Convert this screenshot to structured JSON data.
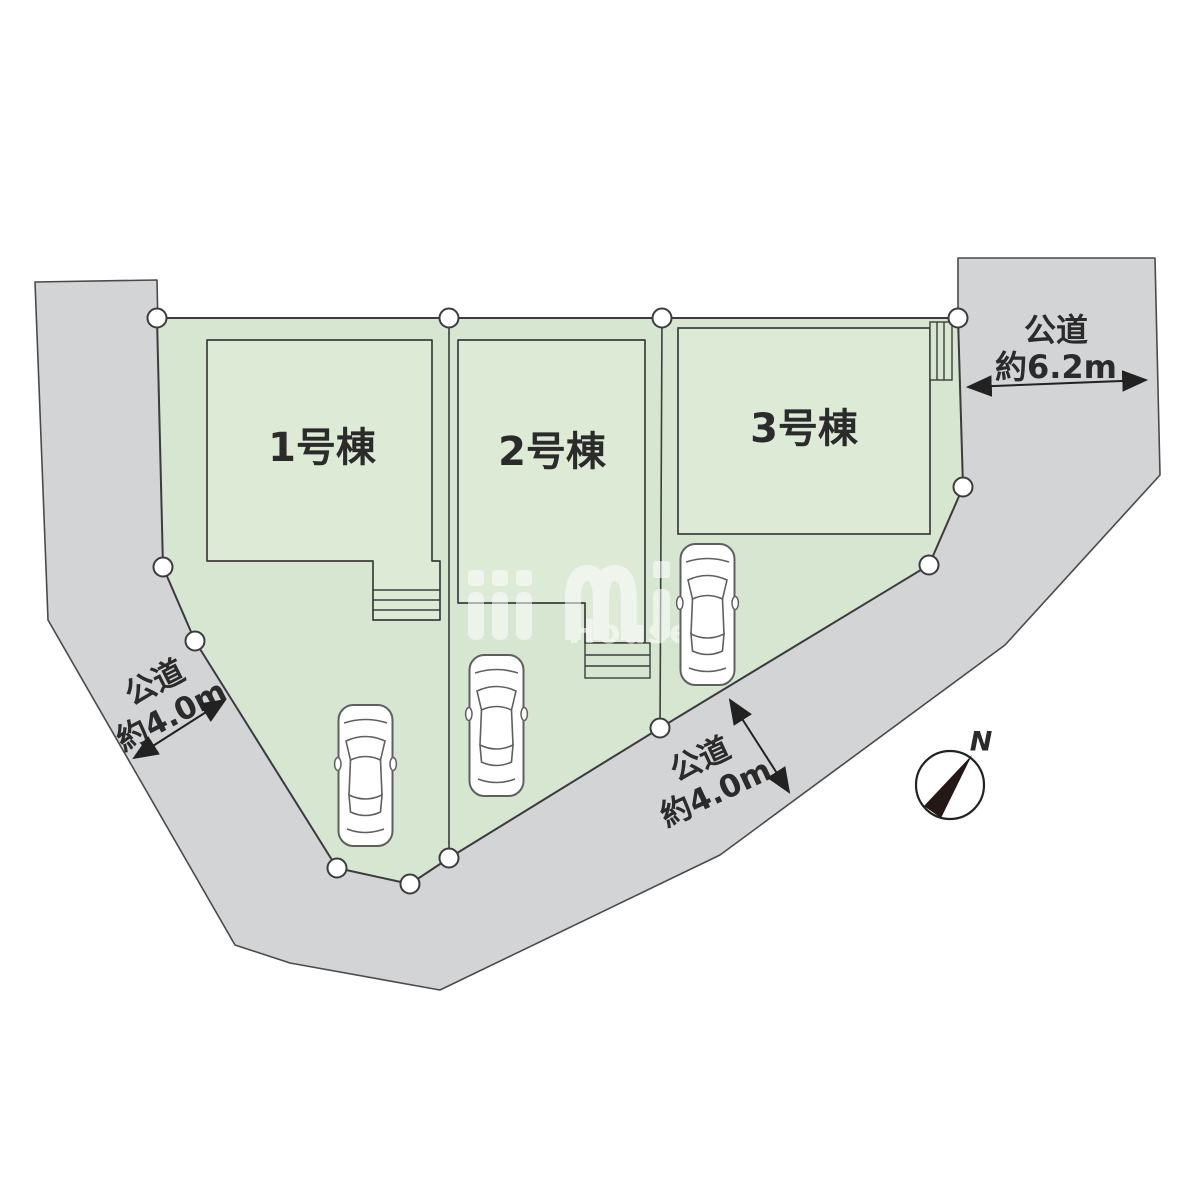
{
  "diagram": {
    "type": "residential-site-plan",
    "lots": [
      {
        "id": "lot1",
        "label": "1号棟"
      },
      {
        "id": "lot2",
        "label": "2号棟"
      },
      {
        "id": "lot3",
        "label": "3号棟"
      }
    ],
    "roads": {
      "left": {
        "name": "公道",
        "width": "約4.0m"
      },
      "bottom": {
        "name": "公道",
        "width": "約4.0m"
      },
      "right": {
        "name": "公道",
        "width": "約6.2m"
      }
    },
    "compass": {
      "north_label": "N"
    },
    "watermark": {
      "logo_text": "mi",
      "tagline": "House &"
    },
    "features": {
      "cars": 3,
      "boundary_markers": 12,
      "stair_blocks": 3
    }
  },
  "colors": {
    "background": "#ffffff",
    "road_fill": "#d3d4d6",
    "parcel_fill": "#d6e6d0",
    "building_fill": "#dcead6",
    "outline": "#3c3c3e",
    "text": "#2b2b2b",
    "compass_needle": "#231815",
    "watermark": "#ffffff"
  }
}
